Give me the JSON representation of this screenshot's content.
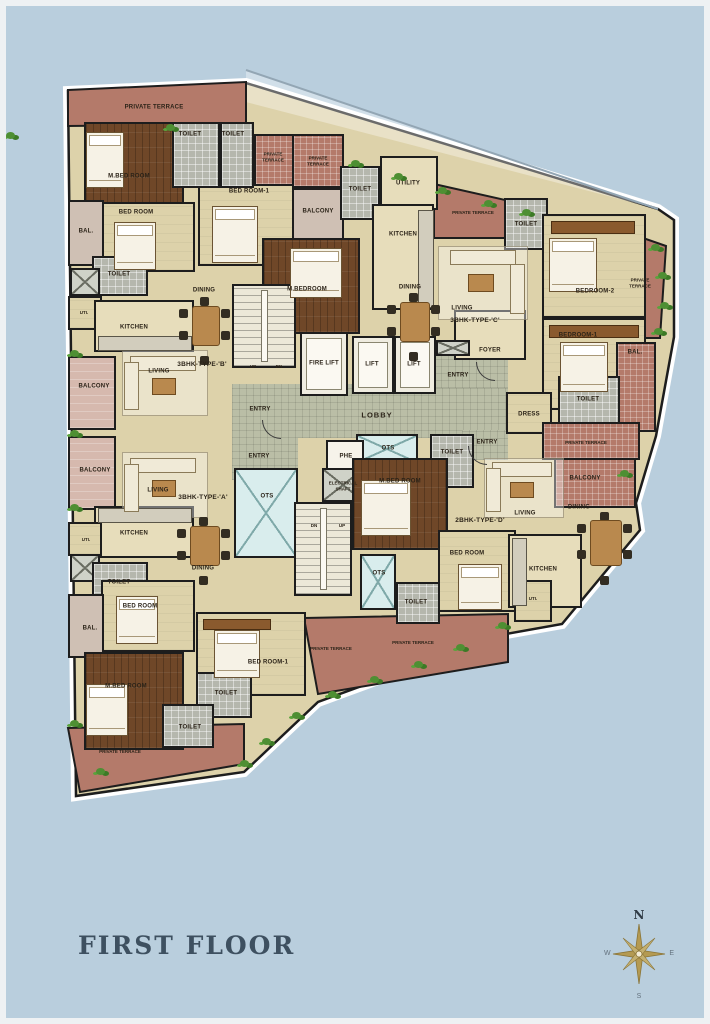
{
  "title": "FIRST FLOOR",
  "labels": {
    "private_terrace": "PRIVATE TERRACE",
    "m_bed_room": "M.BED ROOM",
    "m_bedroom": "M.BEDROOM",
    "bed_room": "BED ROOM",
    "bed_room_1": "BED ROOM-1",
    "bedroom_1": "BEDROOM-1",
    "bedroom_2": "BEDROOM-2",
    "toilet": "TOILET",
    "bal": "BAL.",
    "balcony": "BALCONY",
    "kitchen": "KITCHEN",
    "uti": "UTI.",
    "utility": "UTILITY",
    "dining": "DINING",
    "living": "LIVING",
    "dress": "DRESS",
    "foyer": "FOYER",
    "lobby": "LOBBY",
    "entry": "ENTRY",
    "fire_lift": "FIRE LIFT",
    "lift": "LIFT",
    "ots": "OTS",
    "phe": "PHE",
    "elec_shaft": "ELECTRICAL SHAFT",
    "up": "UP",
    "dn": "DN",
    "type_a": "3BHK-TYPE-'A'",
    "type_b": "3BHK-TYPE-'B'",
    "type_c": "3BHK-TYPE-'C'",
    "type_d": "2BHK-TYPE-'D'"
  },
  "compass": {
    "n": "N",
    "e": "E",
    "s": "S",
    "w": "W"
  },
  "colors": {
    "background": "#b9cedd",
    "wall": "#1d1d1d",
    "floor_tan": "#ddd2aa",
    "terrace_brick": "#b47a6a",
    "wood_dark": "#6f4728",
    "toilet_gray": "#b5b7ad",
    "lobby_tile": "#babea6",
    "ots_blue": "#d9eded",
    "greenery": "#4e8f33",
    "title_text": "#3e5060"
  }
}
